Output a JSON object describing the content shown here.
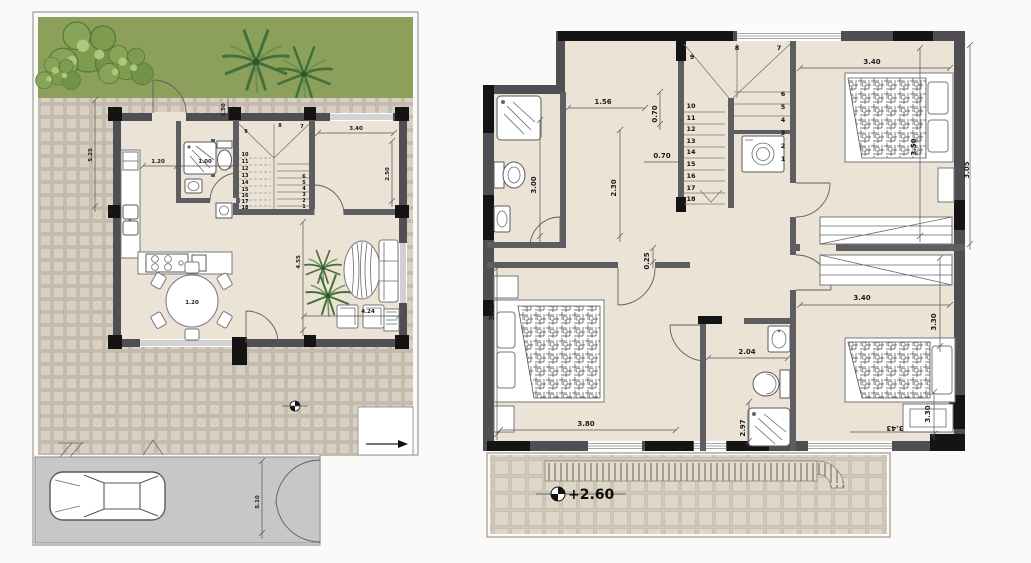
{
  "colors": {
    "wall": "#4f4f53",
    "wall_int": "#5e5e62",
    "wall_dark": "#141414",
    "floor": "#eae3d6",
    "garden": "#8ca05c",
    "tree": "#7d9c4e",
    "tree_dark": "#56783a",
    "tree_light": "#aec77d",
    "palm": "#44703a",
    "tile": "#c3bab0",
    "tile_face": "#d8d0c2",
    "terrace": "#ded7c8",
    "terrace_line": "#bdb4a4",
    "drive": "#c7c7c7",
    "dim_text": "#1c1c1c"
  },
  "ground_floor": {
    "dims": [
      {
        "t": "5.25",
        "x": 92,
        "y": 155,
        "r": -90
      },
      {
        "t": "1.50",
        "x": 225,
        "y": 110,
        "r": -90
      },
      {
        "t": "1.20",
        "x": 158,
        "y": 163,
        "r": 0
      },
      {
        "t": "1.00",
        "x": 205,
        "y": 163,
        "r": 0
      },
      {
        "t": "3.40",
        "x": 356,
        "y": 130,
        "r": 0
      },
      {
        "t": "2.50",
        "x": 389,
        "y": 174,
        "r": -90
      },
      {
        "t": "4.55",
        "x": 300,
        "y": 262,
        "r": -90
      },
      {
        "t": "1.20",
        "x": 192,
        "y": 304,
        "r": 0
      },
      {
        "t": "4.24",
        "x": 368,
        "y": 313,
        "r": 0
      },
      {
        "t": "5.10",
        "x": 259,
        "y": 502,
        "r": -90
      }
    ],
    "stair_numbers": [
      "1",
      "2",
      "3",
      "4",
      "5",
      "6",
      "7",
      "8",
      "9",
      "10",
      "11",
      "12",
      "13",
      "14",
      "15",
      "16",
      "17",
      "18"
    ]
  },
  "upper_floor": {
    "dims": [
      {
        "t": "1.56",
        "x": 603,
        "y": 104,
        "r": 0
      },
      {
        "t": "0.70",
        "x": 657,
        "y": 114,
        "r": -90
      },
      {
        "t": "0.70",
        "x": 662,
        "y": 158,
        "r": 0
      },
      {
        "t": "3.00",
        "x": 536,
        "y": 185,
        "r": -90
      },
      {
        "t": "2.30",
        "x": 616,
        "y": 188,
        "r": -90
      },
      {
        "t": "0.25",
        "x": 649,
        "y": 261,
        "r": -90
      },
      {
        "t": "3.40",
        "x": 872,
        "y": 64,
        "r": 0
      },
      {
        "t": "3.50",
        "x": 916,
        "y": 147,
        "r": -90
      },
      {
        "t": "3.05",
        "x": 969,
        "y": 170,
        "r": -90
      },
      {
        "t": "3.85",
        "x": 494,
        "y": 312,
        "r": -90
      },
      {
        "t": "3.80",
        "x": 586,
        "y": 426,
        "r": 0
      },
      {
        "t": "2.04",
        "x": 747,
        "y": 354,
        "r": 0
      },
      {
        "t": "2.97",
        "x": 745,
        "y": 428,
        "r": -90
      },
      {
        "t": "3.40",
        "x": 862,
        "y": 300,
        "r": 0
      },
      {
        "t": "3.30",
        "x": 936,
        "y": 322,
        "r": -90
      },
      {
        "t": "3.30",
        "x": 930,
        "y": 414,
        "r": -90
      },
      {
        "t": "3.43",
        "x": 895,
        "y": 426,
        "r": 180
      }
    ],
    "stair_numbers": [
      "1",
      "2",
      "3",
      "4",
      "5",
      "6",
      "7",
      "8",
      "9",
      "10",
      "11",
      "12",
      "13",
      "14",
      "15",
      "16",
      "17",
      "18"
    ],
    "level_label": "+2.60"
  }
}
